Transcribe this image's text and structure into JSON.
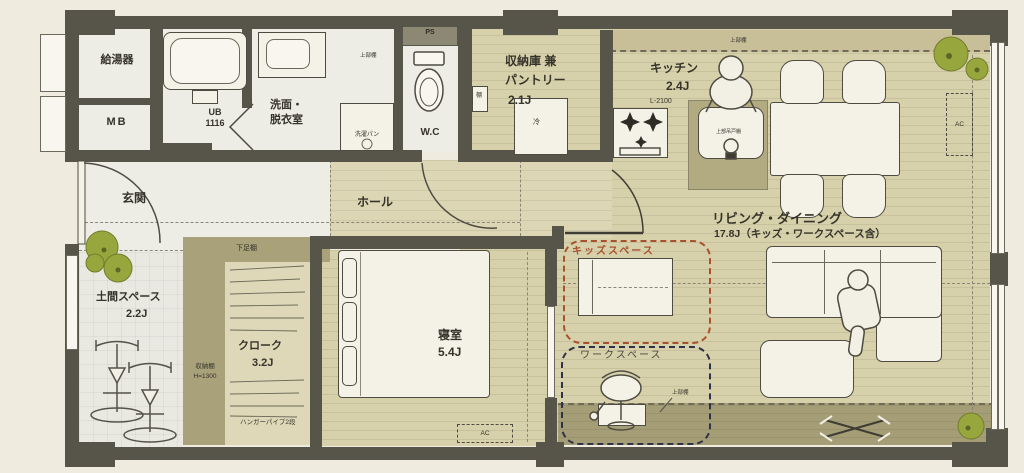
{
  "meta": {
    "type": "floor-plan"
  },
  "palette": {
    "wall": "#57554a",
    "wood_floor": "#d7d1ab",
    "service_floor": "#edece5",
    "shelf_band": "#a8a17a",
    "balcony": "#a49d76",
    "kids_accent": "#a8512d",
    "workspace_accent": "#2e3148",
    "plant_green": "#98a63e",
    "text": "#35332a"
  },
  "rooms": {
    "water_heater": {
      "label": "給湯器"
    },
    "meter_box": {
      "label": "MB"
    },
    "unit_bath": {
      "label": "UB",
      "size": "1116"
    },
    "washroom": {
      "line1": "洗面・",
      "line2": "脱衣室"
    },
    "wc": {
      "label": "W.C"
    },
    "pipe_space": {
      "label": "PS"
    },
    "pantry": {
      "line1": "収納庫 兼",
      "line2": "パントリー",
      "area": "2.1J"
    },
    "kitchen": {
      "label": "キッチン",
      "area": "2.4J"
    },
    "entrance": {
      "label": "玄関"
    },
    "hall": {
      "label": "ホール"
    },
    "doma": {
      "label": "土間スペース",
      "area": "2.2J"
    },
    "cloak": {
      "label": "クローク",
      "area": "3.2J"
    },
    "bedroom": {
      "label": "寝室",
      "area": "5.4J"
    },
    "living": {
      "label": "リビング・ダイニング",
      "area": "17.8J（キッズ・ワークスペース含）"
    },
    "kids_space": {
      "label": "キッズスペース"
    },
    "workspace": {
      "label": "ワークスペース"
    }
  },
  "fixtures": {
    "counter_length": "L-2100",
    "washer_pan": "洗濯パン",
    "upper_shelf": "上部棚",
    "upper_cabinet": "上部吊戸棚",
    "shoe_shelf": "下足棚",
    "storage_shelf": "収納棚",
    "storage_shelf_height": "H=1300",
    "hanger_pipe": "ハンガーパイプ2段",
    "fridge": "冷",
    "shelf": "棚",
    "ac": "AC"
  }
}
